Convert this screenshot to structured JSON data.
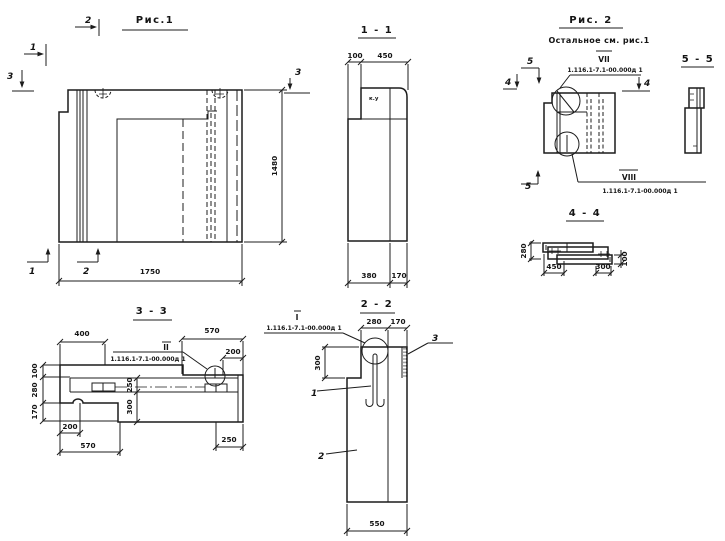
{
  "colors": {
    "ink": "#1c1c1c",
    "paper": "#ffffff"
  },
  "fig1": {
    "title": "Рис.1",
    "dim_width": "1750",
    "dim_height": "1480",
    "marker_top_1": "1",
    "marker_top_2": "2",
    "marker_left_3": "3",
    "marker_bottom_1": "1",
    "marker_bottom_2": "2",
    "marker_right_3": "3"
  },
  "sec11": {
    "title": "1 - 1",
    "d100": "100",
    "d450": "450",
    "d380": "380",
    "d170": "170",
    "note": "к.у"
  },
  "fig2": {
    "title": "Рис. 2",
    "subtitle": "Остальное см. рис.1",
    "roman_top": "VII",
    "doc_top": "1.116.1-7.1-00.000д 1",
    "roman_bottom": "VIII",
    "doc_bottom": "1.116.1-7.1-00.000д 1",
    "m5_top": "5",
    "m4_left": "4",
    "m4_right": "4",
    "m5_bottom": "5"
  },
  "sec55": {
    "title": "5 - 5"
  },
  "sec44": {
    "title": "4 - 4",
    "dim_left": "280",
    "dim_right": "100",
    "dim_b1": "450",
    "dim_b2": "300"
  },
  "sec33": {
    "title": "3 - 3",
    "roman": "II",
    "doc": "1.116.1-7.1-00.000д 1",
    "t400": "400",
    "t570": "570",
    "r200": "200",
    "l100": "100",
    "l280": "280",
    "l170": "170",
    "m250": "250",
    "m300": "300",
    "b200": "200",
    "b570": "570",
    "b250": "250"
  },
  "sec22": {
    "title": "2 - 2",
    "roman": "I",
    "doc": "1.116.1-7.1-00.000д 1",
    "d280": "280",
    "d170": "170",
    "d300": "300",
    "d550": "550",
    "p1": "1",
    "p2": "2",
    "p3": "3"
  }
}
